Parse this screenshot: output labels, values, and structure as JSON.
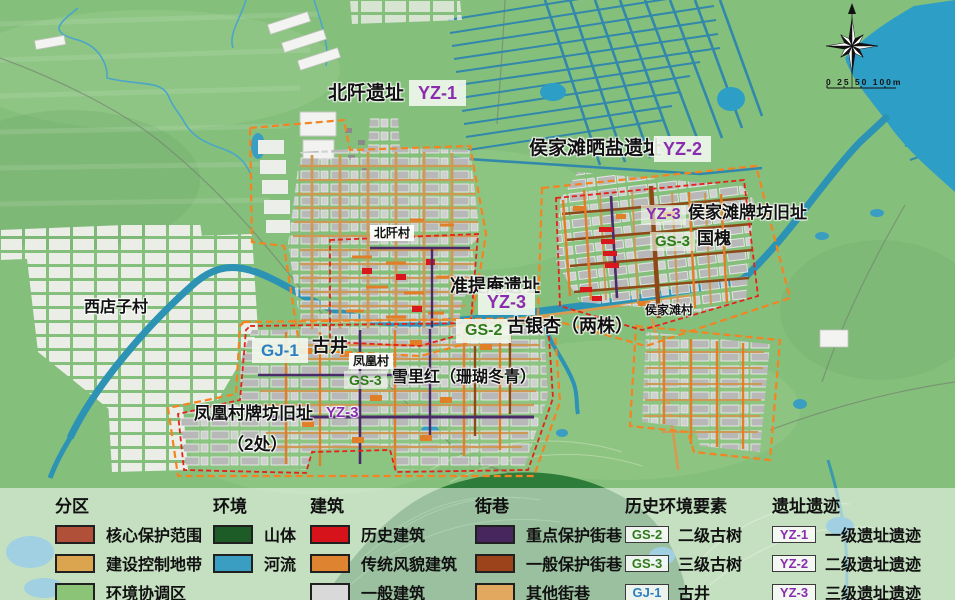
{
  "map": {
    "labels": {
      "beiqian_site": "北阡遗址",
      "beiqian_site_badge": "YZ-1",
      "houjiatan_salt_site": "侯家滩晒盐遗址",
      "houjiatan_salt_badge": "YZ-2",
      "houjiatan_paifang_badge": "YZ-3",
      "houjiatan_paifang_site": "侯家滩牌坊旧址",
      "guohuai_badge": "GS-3",
      "guohuai": "国槐",
      "zhuntian_site": "准提庵遗址",
      "zhuntian_badge": "YZ-3",
      "ginkgo_badge": "GS-2",
      "ginkgo": "古银杏（两株）",
      "xidianzi_village": "西店子村",
      "well_badge": "GJ-1",
      "well": "古井",
      "fenghuang_village": "凤凰村",
      "xuelihong_badge": "GS-3",
      "xuelihong": "雪里红（珊瑚冬青）",
      "fenghuang_paifang_site": "凤凰村牌坊旧址",
      "fenghuang_paifang_badge": "YZ-3",
      "fenghuang_paifang_count": "（2处）",
      "beiqian_village": "北阡村",
      "houjiatan_village": "侯家滩村"
    },
    "scale_text": "0 25 50 100m"
  },
  "colors": {
    "yz": "#8a2bb0",
    "gs": "#2f7a1a",
    "gj": "#2d7ec0"
  },
  "legend": {
    "sections": [
      {
        "title": "分区",
        "items": [
          {
            "swatch": "#b05038",
            "label": "核心保护范围"
          },
          {
            "swatch": "#dba44e",
            "label": "建设控制地带"
          },
          {
            "swatch": "#8cc477",
            "label": "环境协调区"
          }
        ]
      },
      {
        "title": "环境",
        "items": [
          {
            "swatch": "#1d5b27",
            "label": "山体"
          },
          {
            "swatch": "#3a9dc2",
            "label": "河流"
          }
        ]
      },
      {
        "title": "建筑",
        "items": [
          {
            "swatch": "#d6131a",
            "label": "历史建筑"
          },
          {
            "swatch": "#de8430",
            "label": "传统风貌建筑"
          },
          {
            "swatch": "#d9d9d9",
            "label": "一般建筑"
          }
        ]
      },
      {
        "title": "街巷",
        "items": [
          {
            "swatch": "#46265c",
            "label": "重点保护街巷"
          },
          {
            "swatch": "#9c431c",
            "label": "一般保护街巷"
          },
          {
            "swatch": "#e2a85f",
            "label": "其他街巷"
          }
        ]
      },
      {
        "title": "历史环境要素",
        "items": [
          {
            "badge": "GS-2",
            "badge_color": "#2f7a1a",
            "label": "二级古树"
          },
          {
            "badge": "GS-3",
            "badge_color": "#2f7a1a",
            "label": "三级古树"
          },
          {
            "badge": "GJ-1",
            "badge_color": "#2d7ec0",
            "label": "古井"
          }
        ]
      },
      {
        "title": "遗址遗迹",
        "items": [
          {
            "badge": "YZ-1",
            "badge_color": "#8a2bb0",
            "label": "一级遗址遗迹"
          },
          {
            "badge": "YZ-2",
            "badge_color": "#8a2bb0",
            "label": "二级遗址遗迹"
          },
          {
            "badge": "YZ-3",
            "badge_color": "#8a2bb0",
            "label": "三级遗址遗迹"
          }
        ]
      }
    ]
  }
}
